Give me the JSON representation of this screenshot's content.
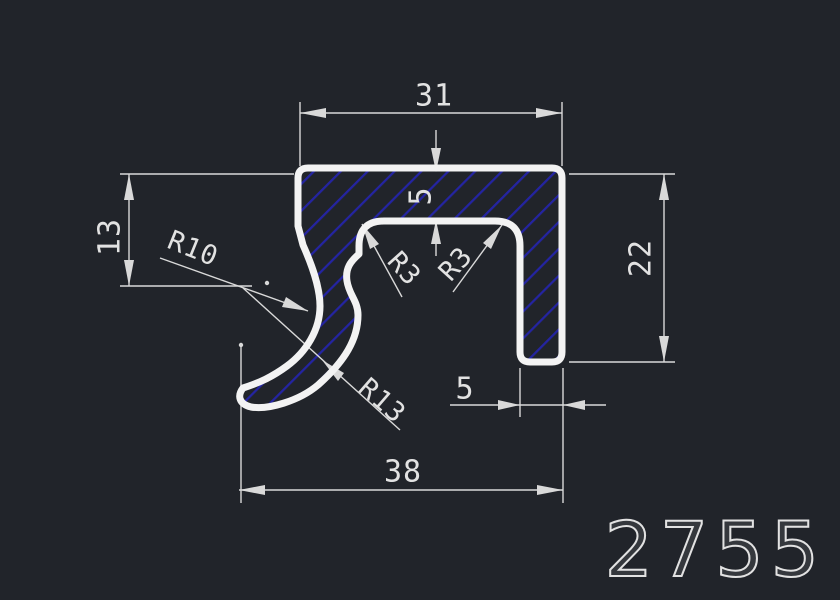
{
  "drawing": {
    "part_number": "2755",
    "dimensions": {
      "top_width": "31",
      "wall_thickness": "5",
      "left_height": "13",
      "right_height": "22",
      "leg_width": "5",
      "bottom_width": "38"
    },
    "radii": {
      "inner_hook": "R10",
      "fillet_left": "R3",
      "fillet_right": "R3",
      "outer_hook": "R13"
    },
    "colors": {
      "background": "#21242a",
      "profile_outline": "#f3f3f3",
      "hatch_blue": "#2424a2",
      "dimension_lines": "#d9d9d9",
      "dimension_text": "#e2e2e2"
    }
  }
}
